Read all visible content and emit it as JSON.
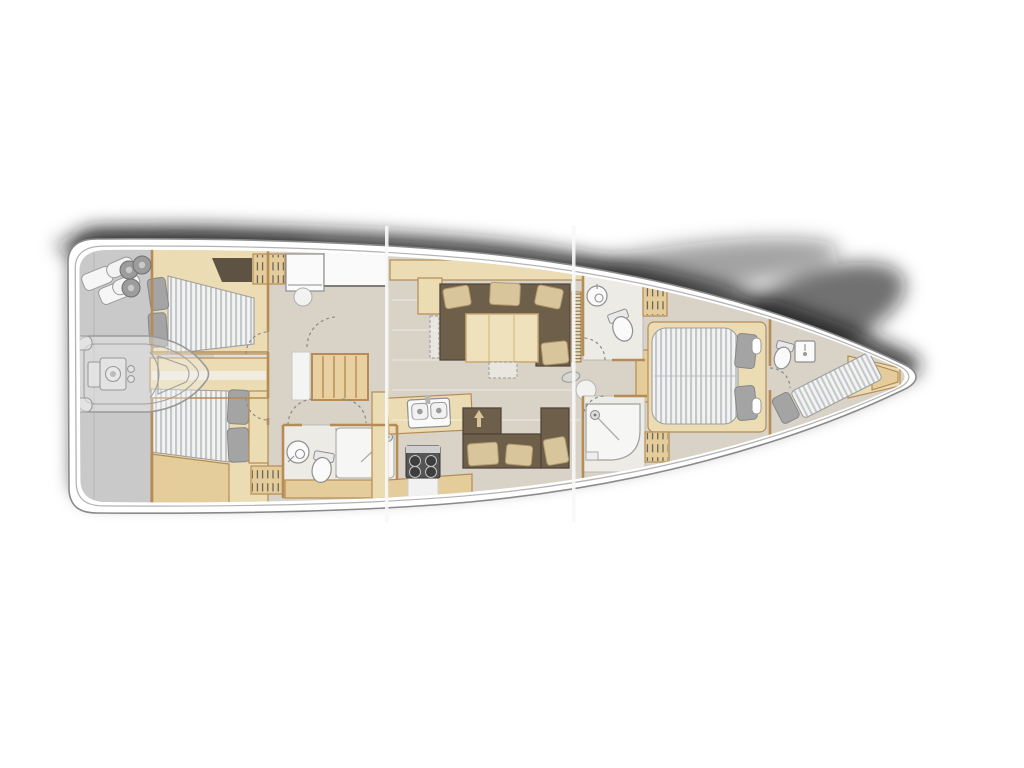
{
  "page": {
    "background": "#ffffff"
  },
  "palette": {
    "bg": "#ffffff",
    "hull_stroke": "#8a8a8a",
    "inner_stroke": "#b3b3b3",
    "shadow": "#151515",
    "deck_gray": "#c9c9c9",
    "deck_gray_mid": "#d2d1ce",
    "deck_gray_light": "#e4e2de",
    "floor_greige": "#d8d2c7",
    "room_white": "#edebe5",
    "wood_light": "#ecdcb4",
    "wood_mid": "#e4cc9b",
    "wood_edge": "#b58c55",
    "dark_opening": "#5e5243",
    "sofa": "#6e5f4b",
    "sofa_edge": "#51453a",
    "cushion": "#d8c59b",
    "cushion_edge": "#b29a6d",
    "mattress": "#f3f3f2",
    "mattress_stripe": "#c5c8cb",
    "pillow": "#a4a4a4",
    "pillow_edge": "#878787",
    "fixture": "#fafafa",
    "fixture_edge": "#8f8f8f",
    "stairs": "#e9d0a0",
    "arc_color": "#8a8a8a",
    "seam": "#f7f7f6"
  },
  "diagram": {
    "type": "sailing-yacht-interior-floor-plan",
    "view": "top-down",
    "bow_direction": "right",
    "areas": [
      "stern-garage-with-tender",
      "aft-cabin-port",
      "aft-cabin-starboard",
      "aft-heads",
      "nav-station",
      "companionway-stairs",
      "galley",
      "salon",
      "forward-head",
      "forward-shower",
      "owner-cabin",
      "bow-crew-cabin"
    ]
  }
}
